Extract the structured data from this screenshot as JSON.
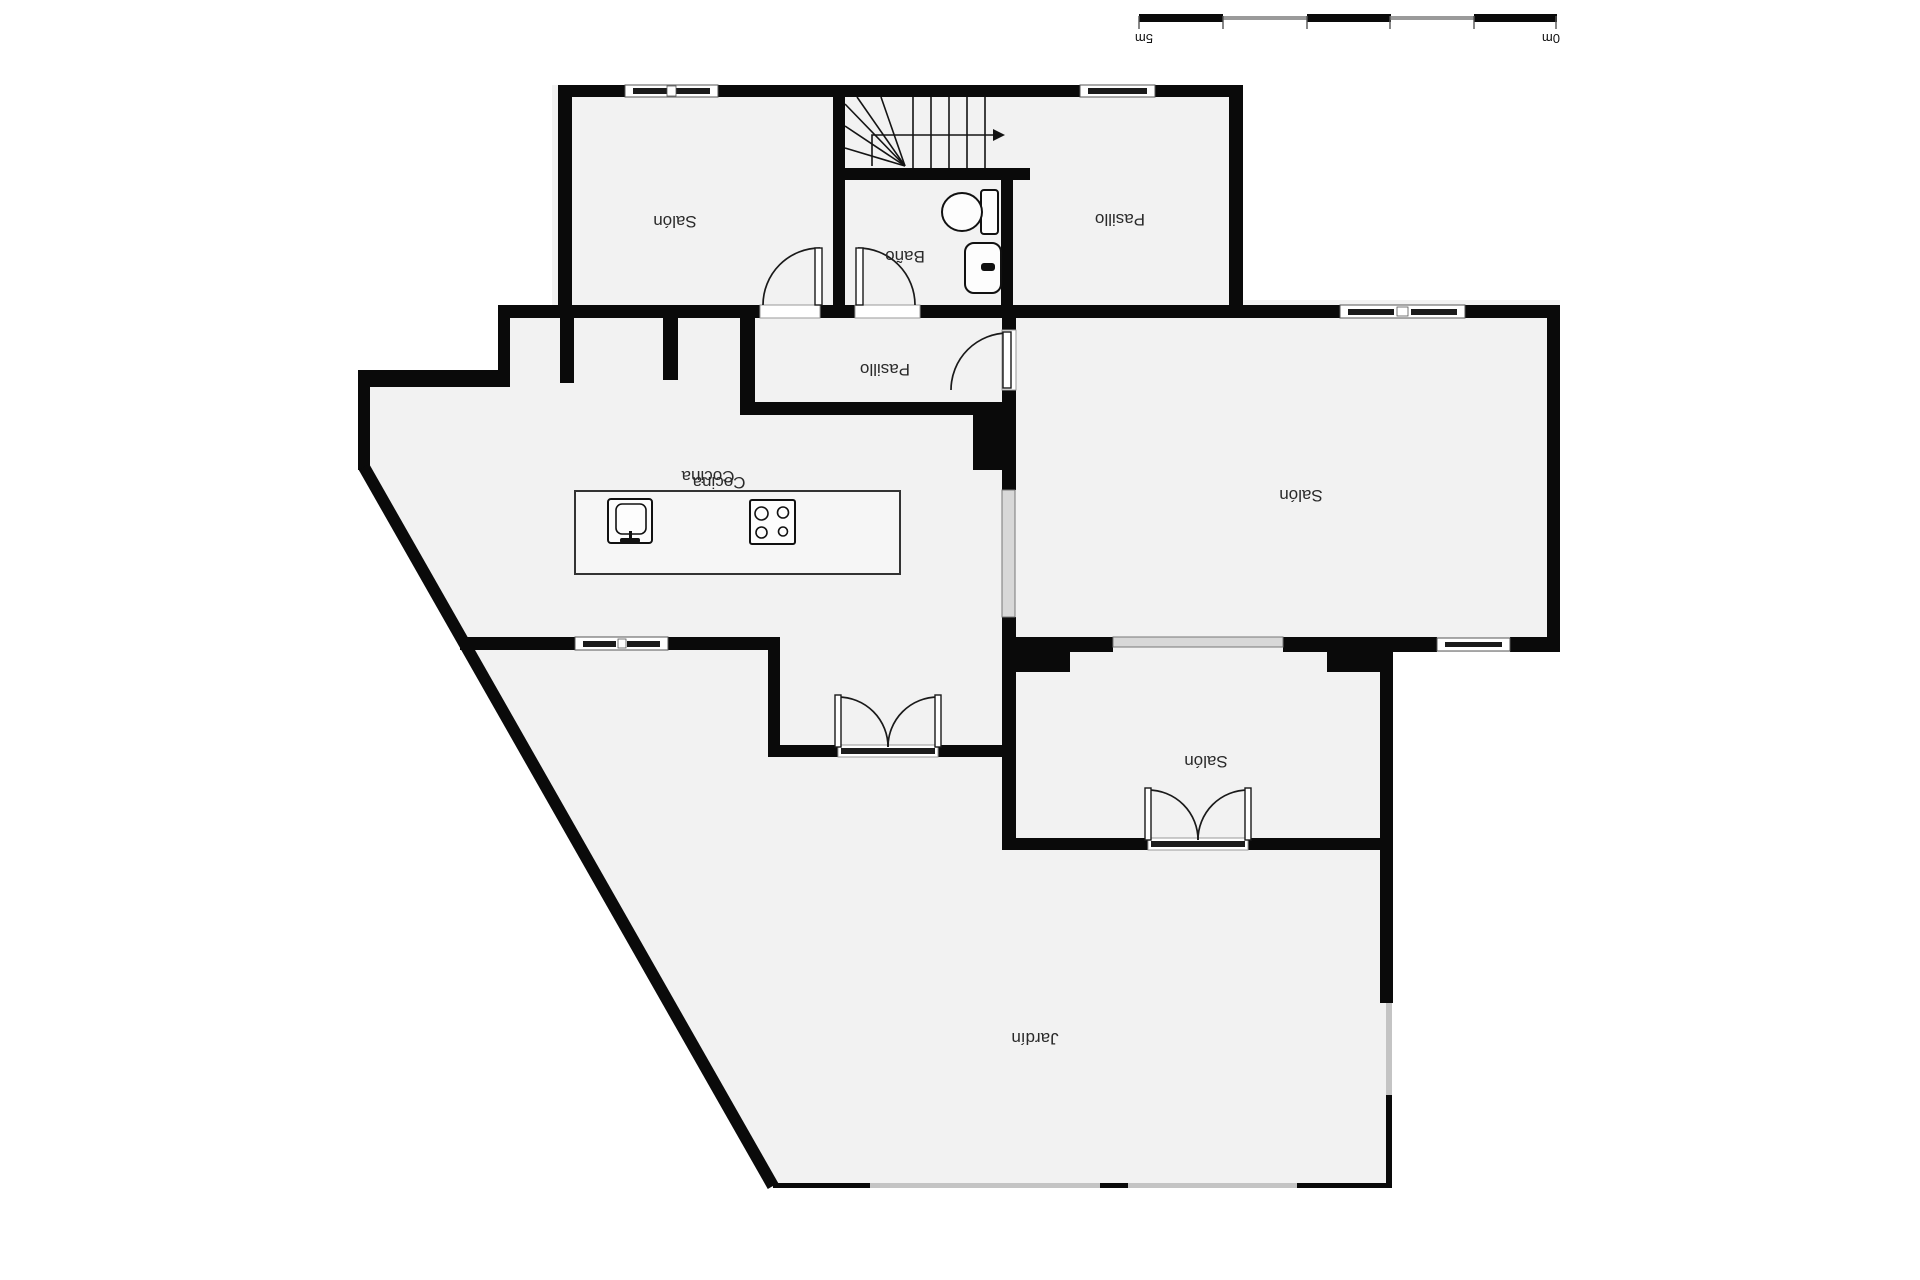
{
  "scale_bar": {
    "left_label": "5m",
    "right_label": "0m"
  },
  "rooms": {
    "salon_top_left": {
      "label": "Salón"
    },
    "pasillo_top": {
      "label": "Pasillo"
    },
    "bano": {
      "label": "Baño"
    },
    "pasillo_middle": {
      "label": "Pasillo"
    },
    "cocina": {
      "label": "Cocina"
    },
    "salon_right": {
      "label": "Salón"
    },
    "salon_bottom": {
      "label": "Salón"
    },
    "jardin": {
      "label": "Jardín"
    }
  },
  "fixtures": {
    "stairs": "stairs-with-direction-arrow",
    "toilet": "toilet-icon",
    "bathroom_sink": "sink-icon",
    "kitchen_island": "kitchen-island",
    "kitchen_sink": "kitchen-sink-icon",
    "stove": "stove-icon"
  },
  "colors": {
    "wall": "#0a0a0a",
    "floor": "#f2f2f2",
    "glazing": "#d8d8d8",
    "background": "#ffffff",
    "text": "#2a2a2a"
  }
}
